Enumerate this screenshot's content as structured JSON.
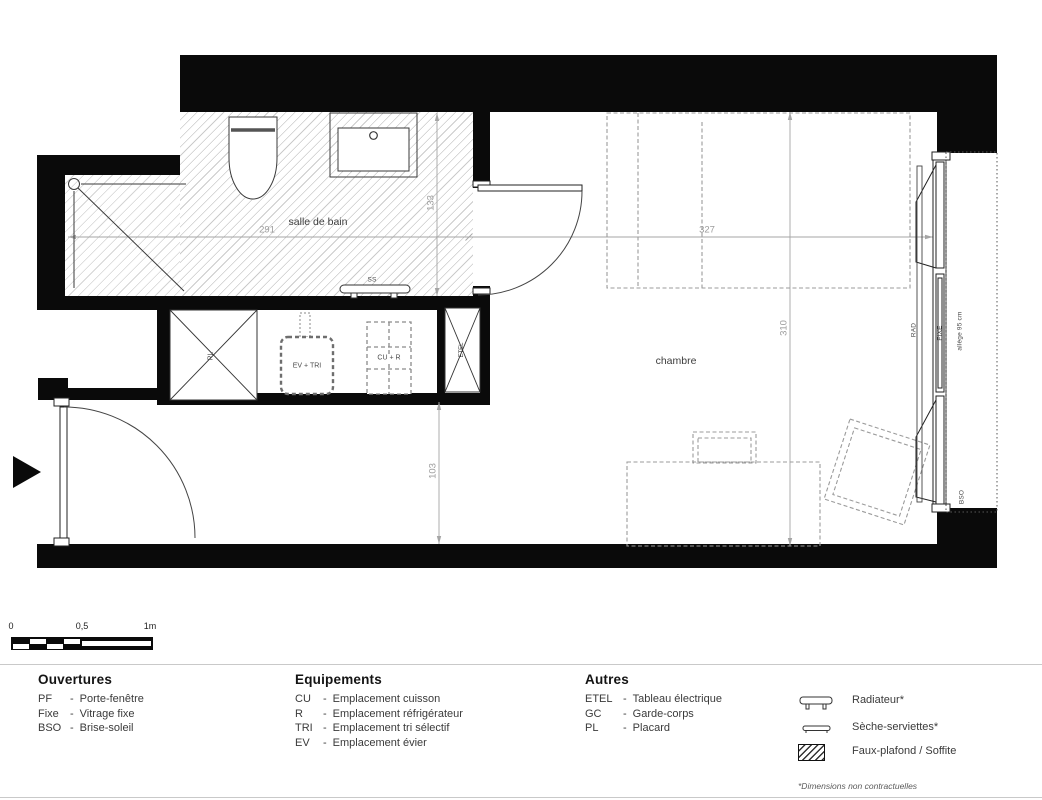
{
  "plan": {
    "bathroom_label": "salle de bain",
    "bedroom_label": "chambre",
    "towel_rail_label": "SS",
    "closet_label": "PL",
    "sink_label": "EV + TRI",
    "cooking_label": "CU + R",
    "electrical_label": "ETEL",
    "radiator_label": "RAD",
    "fixed_glazing_label": "FIXE",
    "sill_label": "allège 95 cm",
    "bso_label": "BSO",
    "dim_bath_width": "291",
    "dim_bath_depth": "133",
    "dim_room_width": "327",
    "dim_room_depth": "310",
    "dim_hall_depth": "103"
  },
  "scalebar": {
    "zero": "0",
    "half": "0,5",
    "one": "1m"
  },
  "legend": {
    "sep": "-",
    "openings": {
      "title": "Ouvertures",
      "items": [
        {
          "abbr": "PF",
          "label": "Porte-fenêtre"
        },
        {
          "abbr": "Fixe",
          "label": "Vitrage fixe"
        },
        {
          "abbr": "BSO",
          "label": "Brise-soleil"
        }
      ]
    },
    "equipment": {
      "title": "Equipements",
      "items": [
        {
          "abbr": "CU",
          "label": "Emplacement cuisson"
        },
        {
          "abbr": "R",
          "label": "Emplacement réfrigérateur"
        },
        {
          "abbr": "TRI",
          "label": "Emplacement tri sélectif"
        },
        {
          "abbr": "EV",
          "label": "Emplacement évier"
        }
      ]
    },
    "others": {
      "title": "Autres",
      "items": [
        {
          "abbr": "ETEL",
          "label": "Tableau électrique"
        },
        {
          "abbr": "GC",
          "label": "Garde-corps"
        },
        {
          "abbr": "PL",
          "label": "Placard"
        }
      ]
    },
    "symbols": {
      "radiator": "Radiateur*",
      "towel": "Sèche-serviettes*",
      "soffit": "Faux-plafond / Soffite"
    },
    "footnote": "*Dimensions non contractuelles"
  },
  "colors": {
    "wall": "#0a0a0a",
    "dimension_line": "#a5a5a5",
    "hatch_line": "#cbcbcb",
    "drawing_line": "#2e2e2e",
    "furniture_dashed": "#9b9b9b"
  }
}
